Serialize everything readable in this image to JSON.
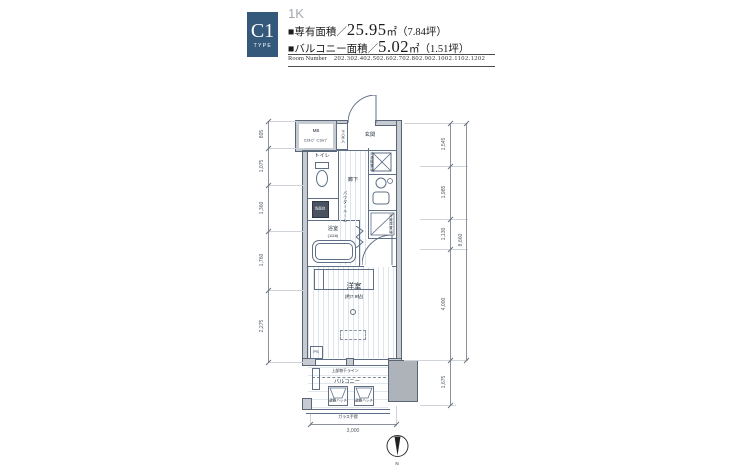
{
  "colors": {
    "accent": "#35597b"
  },
  "header": {
    "type_code": "C1",
    "type_word": "TYPE",
    "layout_type": "1K",
    "area1_label": "■専有面積／",
    "area1_value": "25.95",
    "area1_unit": "㎡（7.84坪）",
    "area2_label": "■バルコニー面積／",
    "area2_value": "5.02",
    "area2_unit": "㎡（1.51坪）",
    "room_number_label": "Room Number",
    "room_numbers": "202.302.402.502.602.702.802.902.1002.1102.1202"
  },
  "plan": {
    "rooms": {
      "entrance": "玄関",
      "toilet": "トイレ",
      "hallway": "廊下",
      "powder_room": "パウダールーム",
      "bathroom": "浴室",
      "bathroom_size": "(1116)",
      "western_room": "洋室",
      "western_room_size": "(約7.9帖)",
      "balcony": "バルコニー"
    },
    "fixtures": {
      "meter_box": "MB",
      "meter_box_types": "C2ﾀｲﾌﾟ C1ﾀｲﾌﾟ",
      "shoe_box": "下足入",
      "vanity": "洗面台",
      "washer": "洗濯機置場",
      "refrigerator": "冷蔵庫置場",
      "pipe_space": "PS",
      "laundry_line": "上部物干ライン",
      "evacuation_hatch": "避難ハッチ",
      "glass_rail": "ガラス手摺"
    },
    "dims": {
      "left": [
        "805",
        "1,075",
        "1,360",
        "1,760",
        "2,275"
      ],
      "right": [
        "1,545",
        "1,985",
        "1,130",
        "4,000"
      ],
      "right_total": "8,660",
      "balcony_depth": "1,675",
      "bottom_width": "3,000"
    },
    "compass": {
      "north": "N"
    }
  }
}
